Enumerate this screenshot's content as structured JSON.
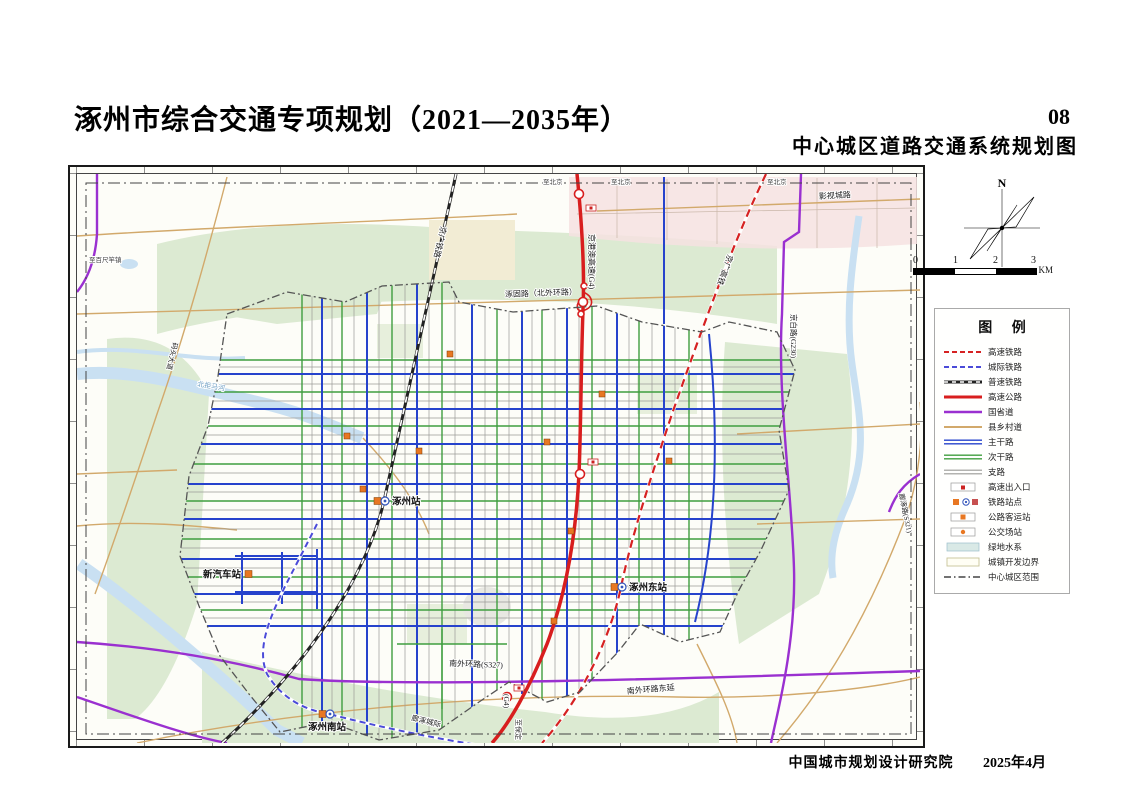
{
  "header": {
    "title": "涿州市综合交通专项规划（2021—2035年）",
    "page_no": "08",
    "subtitle": "中心城区道路交通系统规划图"
  },
  "footer": {
    "org": "中国城市规划设计研究院",
    "date": "2025年4月"
  },
  "compass": {
    "north_label": "N"
  },
  "scalebar": {
    "ticks": [
      "0",
      "1",
      "2",
      "3"
    ],
    "unit": "KM"
  },
  "legend": {
    "title": "图 例",
    "items": [
      {
        "label": "高速铁路",
        "swatch": "hsr"
      },
      {
        "label": "城际铁路",
        "swatch": "intercity"
      },
      {
        "label": "普速铁路",
        "swatch": "rail"
      },
      {
        "label": "高速公路",
        "swatch": "expressway"
      },
      {
        "label": "国省道",
        "swatch": "provincial"
      },
      {
        "label": "县乡村道",
        "swatch": "county"
      },
      {
        "label": "主干路",
        "swatch": "arterial"
      },
      {
        "label": "次干路",
        "swatch": "secondary"
      },
      {
        "label": "支路",
        "swatch": "branch"
      },
      {
        "label": "高速出入口",
        "swatch": "ramp"
      },
      {
        "label": "铁路站点",
        "swatch": "railstation"
      },
      {
        "label": "公路客运站",
        "swatch": "busterminal"
      },
      {
        "label": "公交场站",
        "swatch": "busdepot"
      },
      {
        "label": "绿地水系",
        "swatch": "greenwater"
      },
      {
        "label": "城镇开发边界",
        "swatch": "devboundary"
      },
      {
        "label": "中心城区范围",
        "swatch": "centerboundary"
      }
    ]
  },
  "colors": {
    "expressway": "#d81e1e",
    "hsr": "#d62222",
    "railway": "#222222",
    "intercity": "#4b4bd8",
    "provincial": "#9a30d0",
    "county": "#d2a96b",
    "arterial": "#2643cc",
    "secondary": "#3f9e3f",
    "branch": "#9a9a96",
    "greenland": "#dcead2",
    "water": "#c9e0f2",
    "station": "#e87722"
  },
  "map": {
    "road_labels": [
      {
        "text": "京港澳高速(G4)",
        "x": 512,
        "y": 60,
        "rot": 90,
        "size": 8,
        "color": "#1a1a1a"
      },
      {
        "text": "京广铁路",
        "x": 364,
        "y": 52,
        "rot": 103,
        "size": 8,
        "color": "#1a1a1a"
      },
      {
        "text": "京广高铁",
        "x": 651,
        "y": 80,
        "rot": 110,
        "size": 8,
        "color": "#1a1a1a"
      },
      {
        "text": "京白路(G230)",
        "x": 714,
        "y": 140,
        "rot": 90,
        "size": 7.5,
        "color": "#1a1a1a"
      },
      {
        "text": "影视城路",
        "x": 742,
        "y": 25,
        "rot": -3,
        "size": 8,
        "color": "#1a1a1a"
      },
      {
        "text": "涿固路（北外环路）",
        "x": 428,
        "y": 123,
        "rot": -2,
        "size": 8,
        "color": "#1a1a1a"
      },
      {
        "text": "南外环路(S327)",
        "x": 372,
        "y": 492,
        "rot": 2,
        "size": 8,
        "color": "#1a1a1a"
      },
      {
        "text": "南外环路东延",
        "x": 550,
        "y": 520,
        "rot": -5,
        "size": 8,
        "color": "#1a1a1a"
      },
      {
        "text": "廊涿城际",
        "x": 334,
        "y": 546,
        "rot": 14,
        "size": 7.5,
        "color": "#1a1a1a"
      },
      {
        "text": "廊涿路(S321)",
        "x": 822,
        "y": 320,
        "rot": 78,
        "size": 7,
        "color": "#1a1a1a"
      },
      {
        "text": "码头大道",
        "x": 96,
        "y": 168,
        "rot": 103,
        "size": 7,
        "color": "#1a1a1a"
      },
      {
        "text": "北拒马河",
        "x": 120,
        "y": 212,
        "rot": 10,
        "size": 7,
        "color": "#6f9fc4"
      },
      {
        "text": "(G4)",
        "x": 427,
        "y": 520,
        "rot": 90,
        "size": 7.5,
        "color": "#1a1a1a"
      },
      {
        "text": "至保定",
        "x": 439,
        "y": 545,
        "rot": 90,
        "size": 7,
        "color": "#333333"
      }
    ],
    "edge_labels": [
      {
        "text": "至北京",
        "x": 466,
        "y": 10
      },
      {
        "text": "至北京",
        "x": 534,
        "y": 10
      },
      {
        "text": "至北京",
        "x": 690,
        "y": 10
      },
      {
        "text": "至百尺竿镇",
        "x": 12,
        "y": 88
      }
    ],
    "stations": [
      {
        "name": "涿州站",
        "x": 307,
        "y": 327,
        "type": "rail",
        "side": "right"
      },
      {
        "name": "涿州东站",
        "x": 544,
        "y": 413,
        "type": "rail",
        "side": "right"
      },
      {
        "name": "涿州南站",
        "x": 252,
        "y": 540,
        "type": "rail",
        "side": "below"
      },
      {
        "name": "新汽车站",
        "x": 178,
        "y": 400,
        "type": "bus",
        "side": "left"
      }
    ],
    "bus_depots": [
      [
        270,
        262
      ],
      [
        342,
        277
      ],
      [
        286,
        315
      ],
      [
        470,
        268
      ],
      [
        494,
        357
      ],
      [
        592,
        287
      ],
      [
        477,
        447
      ],
      [
        373,
        180
      ],
      [
        525,
        220
      ]
    ],
    "ramp_markers": [
      [
        514,
        34
      ],
      [
        516,
        288
      ],
      [
        442,
        514
      ]
    ]
  }
}
